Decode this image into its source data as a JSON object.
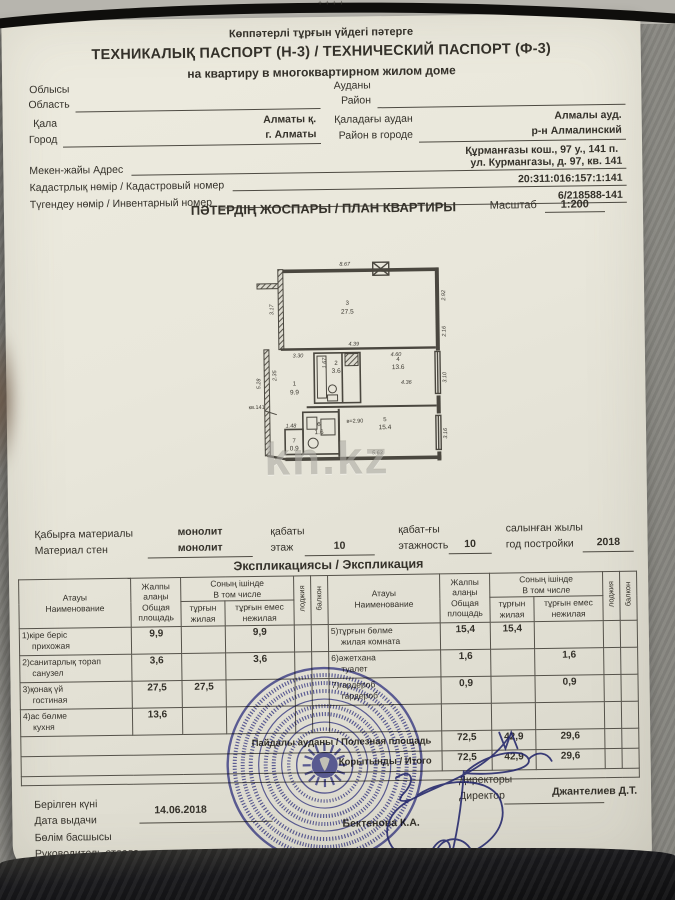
{
  "header": {
    "line1": "Көппәтерлі тұрғын үйдегі пәтерге",
    "line2": "ТЕХНИКАЛЫҚ ПАСПОРТ (Н-3) / ТЕХНИЧЕСКИЙ ПАСПОРТ (Ф-3)",
    "line3": "на квартиру в многоквартирном жилом доме"
  },
  "background": {
    "binding_marks": "++++"
  },
  "fields": {
    "region_kk": "Облысы",
    "region_ru": "Область",
    "district_kk": "Ауданы",
    "district_ru": "Район",
    "city_kk": "Қала",
    "city_ru": "Город",
    "city_value_kk": "Алматы қ.",
    "city_value_ru": "г. Алматы",
    "city_district_kk": "Қаладағы аудан",
    "city_district_ru": "Район в городе",
    "city_district_value_kk": "Алмалы ауд.",
    "city_district_value_ru": "р-н Алмалинский",
    "address_label": "Мекен-жайы Адрес",
    "address_value_kk": "Құрманғазы кош., 97 у., 141 п.",
    "address_value_ru": "ул. Курмангазы, д. 97, кв. 141",
    "cadastral_label": "Кадастрлық нөмір / Кадастровый номер",
    "cadastral_value": "20:311:016:157:1:141",
    "inventory_label": "Түгендеу нөмір / Инвентарный номер",
    "inventory_value": "6/218588-141"
  },
  "plan": {
    "title": "ПӘТЕРДІҢ ЖОСПАРЫ / ПЛАН КВАРТИРЫ",
    "scale_label": "Масштаб",
    "scale_value": "1:200",
    "watermark": "kn.kz",
    "apt_label": "кв.141",
    "height_label": "в=2.90",
    "rooms": [
      {
        "num": "3",
        "area": "27.5"
      },
      {
        "num": "4",
        "area": "13.6"
      },
      {
        "num": "2",
        "area": "3.6"
      },
      {
        "num": "1",
        "area": "9.9"
      },
      {
        "num": "5",
        "area": "15.4"
      },
      {
        "num": "6",
        "area": "1.6"
      },
      {
        "num": "7",
        "area": "0.9"
      }
    ],
    "dims": [
      "8.67",
      "3.17",
      "2.92",
      "4.39",
      "3.30",
      "1.67",
      "4.60",
      "2.16",
      "5.28",
      "2.35",
      "4.36",
      "3.10",
      "3.16",
      "5.63",
      "1.48"
    ]
  },
  "building": {
    "wall_label_kk": "Қабырға материалы",
    "wall_label_ru": "Материал стен",
    "wall_value_kk": "монолит",
    "wall_value_ru": "монолит",
    "floor_label_kk": "қабаты",
    "floor_label_ru": "этаж",
    "floor_value": "10",
    "floors_label_kk": "қабат-ғы",
    "floors_label_ru": "этажность",
    "floors_value": "10",
    "year_label_kk": "салынған жылы",
    "year_label_ru": "год постройки",
    "year_value": "2018"
  },
  "explication": {
    "title": "Экспликациясы / Экспликация",
    "headers": {
      "name_kk": "Атауы",
      "name_ru": "Наименование",
      "total_kk": "Жалпы алаңы",
      "total_ru": "Общая площадь",
      "incl_kk": "Соның ішінде",
      "incl_ru": "В том числе",
      "living_kk": "тұрғын",
      "living_ru": "жилая",
      "nonliving_kk": "тұрғын емес",
      "nonliving_ru": "нежилая",
      "loggia": "лоджия",
      "balcony": "балкон"
    },
    "rows_left": [
      {
        "name_kk": "1)кіре беріс",
        "name_ru": "прихожая",
        "total": "9,9",
        "living": "",
        "nonliving": "9,9"
      },
      {
        "name_kk": "2)санитарлық торап",
        "name_ru": "санузел",
        "total": "3,6",
        "living": "",
        "nonliving": "3,6"
      },
      {
        "name_kk": "3)қонақ үй",
        "name_ru": "гостиная",
        "total": "27,5",
        "living": "27,5",
        "nonliving": ""
      },
      {
        "name_kk": "4)ас бөлме",
        "name_ru": "кухня",
        "total": "13,6",
        "living": "",
        "nonliving": ""
      }
    ],
    "rows_right": [
      {
        "name_kk": "5)тұрғын бөлме",
        "name_ru": "жилая комната",
        "total": "15,4",
        "living": "15,4",
        "nonliving": ""
      },
      {
        "name_kk": "6)әжетхана",
        "name_ru": "туалет",
        "total": "1,6",
        "living": "",
        "nonliving": "1,6"
      },
      {
        "name_kk": "7)гардероб",
        "name_ru": "гардероб",
        "total": "0,9",
        "living": "",
        "nonliving": "0,9"
      },
      {
        "name_kk": "",
        "name_ru": "",
        "total": "",
        "living": "",
        "nonliving": ""
      }
    ],
    "totals": [
      {
        "label": "Пайдалы ауданы / Полезная площадь",
        "total": "72,5",
        "living": "42,9",
        "nonliving": "29,6"
      },
      {
        "label": "Қорытынды / Итого",
        "total": "72,5",
        "living": "42,9",
        "nonliving": "29,6"
      }
    ]
  },
  "footer": {
    "date_label_kk": "Берілген күні",
    "date_label_ru": "Дата выдачи",
    "date_value": "14.06.2018",
    "head_label_kk": "Бөлім басшысы",
    "head_label_ru": "Руководитель отдела",
    "head_name": "Бектенова К.А.",
    "executor_label_kk": "Орындаушы",
    "executor_label_ru": "Исполнитель",
    "executor_name": "Аккасынов М.К.",
    "director_label_kk": "Директоры",
    "director_label_ru": "Директор",
    "director_name": "Джантелиев Д.Т."
  },
  "colors": {
    "paper": "#e9e7db",
    "ink": "#34312a",
    "stamp_blue": "#3b3e9c",
    "pen_ink": "#23266b",
    "background_gray": "#8c8b85"
  }
}
